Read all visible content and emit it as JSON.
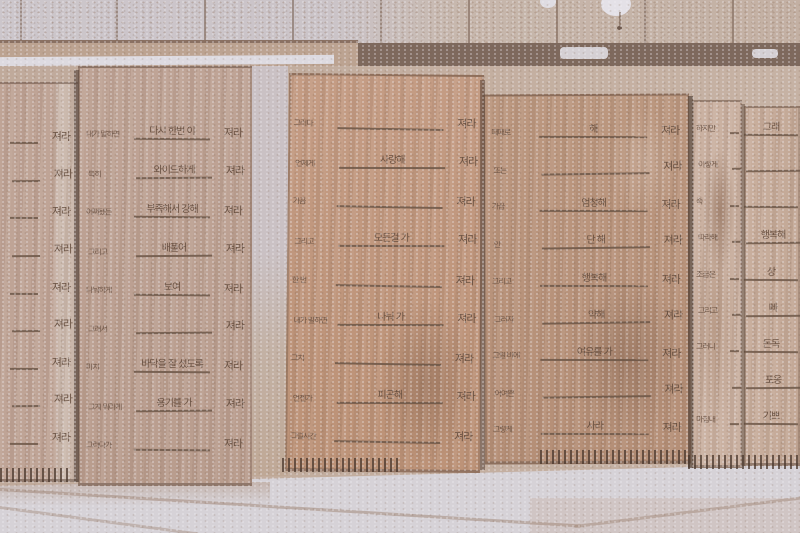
{
  "colors": {
    "tile_light": "#ccc6cb",
    "tile_tan": "#c3b0a3",
    "grout": "#8a7163",
    "shadow_band": "#7e695d",
    "highlight_streak": "#dddae0",
    "wood_a": "#bfa496",
    "wood_b": "#b99d8e",
    "wood_c": "#c49c84",
    "wood_d": "#bb977f",
    "wood_e": "#cab1a1",
    "wood_f": "#c9af9e",
    "ink": "#68513f",
    "floor": "#d6d2d7",
    "floor_line": "#a48b7c"
  },
  "repeated_word": "져라",
  "panels": [
    {
      "name": "board-far-left",
      "rows": [
        {
          "prompt": "",
          "answer": "",
          "suffix": "져라"
        },
        {
          "prompt": "",
          "answer": "",
          "suffix": "져라"
        },
        {
          "prompt": "",
          "answer": "",
          "suffix": "져라"
        },
        {
          "prompt": "",
          "answer": "",
          "suffix": "져라"
        },
        {
          "prompt": "",
          "answer": "",
          "suffix": "져라"
        },
        {
          "prompt": "",
          "answer": "",
          "suffix": "져라"
        },
        {
          "prompt": "",
          "answer": "",
          "suffix": "져라"
        },
        {
          "prompt": "",
          "answer": "",
          "suffix": "져라"
        },
        {
          "prompt": "",
          "answer": "",
          "suffix": "져라"
        }
      ]
    },
    {
      "name": "board-left",
      "rows": [
        {
          "prompt": "내가 말하면",
          "answer": "다시 한번 이",
          "suffix": "져라"
        },
        {
          "prompt": "특히",
          "answer": "와이드하게",
          "suffix": "져라"
        },
        {
          "prompt": "어쩌됐든",
          "answer": "부족해서 강해",
          "suffix": "져라"
        },
        {
          "prompt": "그리고",
          "answer": "배풀어",
          "suffix": "져라"
        },
        {
          "prompt": "나눠하게",
          "answer": "보여",
          "suffix": "져라"
        },
        {
          "prompt": "그래서",
          "answer": "",
          "suffix": "져라"
        },
        {
          "prompt": "마치",
          "answer": "바닥을 잘 섰도록",
          "suffix": "져라"
        },
        {
          "prompt": "그게 뭐라게",
          "answer": "용기를 가",
          "suffix": "져라"
        },
        {
          "prompt": "그러다가",
          "answer": "",
          "suffix": "져라"
        }
      ]
    },
    {
      "name": "board-center",
      "rows": [
        {
          "prompt": "그러다",
          "answer": "",
          "suffix": "져라"
        },
        {
          "prompt": "언제게",
          "answer": "사랑해",
          "suffix": "져라"
        },
        {
          "prompt": "가끔",
          "answer": "",
          "suffix": "져라"
        },
        {
          "prompt": "그리고",
          "answer": "모든걸 가",
          "suffix": "져라"
        },
        {
          "prompt": "한 번",
          "answer": "",
          "suffix": "져라"
        },
        {
          "prompt": "내가 말하면",
          "answer": "나눠 가",
          "suffix": "져라"
        },
        {
          "prompt": "그치",
          "answer": "",
          "suffix": "져라"
        },
        {
          "prompt": "언젠가",
          "answer": "피곤해",
          "suffix": "져라"
        },
        {
          "prompt": "그럴시간",
          "answer": "",
          "suffix": "져라"
        }
      ]
    },
    {
      "name": "board-center-right",
      "rows": [
        {
          "prompt": "때때로",
          "answer": "해",
          "suffix": "져라"
        },
        {
          "prompt": "또는",
          "answer": "",
          "suffix": "져라"
        },
        {
          "prompt": "가끔",
          "answer": "엄청해",
          "suffix": "져라"
        },
        {
          "prompt": "안",
          "answer": "단 해",
          "suffix": "져라"
        },
        {
          "prompt": "그리고",
          "answer": "행복해",
          "suffix": "져라"
        },
        {
          "prompt": "그러자",
          "answer": "약해",
          "suffix": "져라"
        },
        {
          "prompt": "그럴 바에",
          "answer": "여유를 가",
          "suffix": "져라"
        },
        {
          "prompt": "어여쁜",
          "answer": "",
          "suffix": "져라"
        },
        {
          "prompt": "그렇게",
          "answer": "사라",
          "suffix": "져라"
        }
      ]
    },
    {
      "name": "board-right",
      "rows": [
        {
          "prompt": "하지만",
          "answer": "",
          "suffix": ""
        },
        {
          "prompt": "이렇게",
          "answer": "",
          "suffix": ""
        },
        {
          "prompt": "죽",
          "answer": "",
          "suffix": ""
        },
        {
          "prompt": "따라해",
          "answer": "",
          "suffix": ""
        },
        {
          "prompt": "조금은",
          "answer": "",
          "suffix": ""
        },
        {
          "prompt": "그리고",
          "answer": "",
          "suffix": ""
        },
        {
          "prompt": "그러니",
          "answer": "",
          "suffix": ""
        },
        {
          "prompt": "",
          "answer": "",
          "suffix": ""
        },
        {
          "prompt": "마침내",
          "answer": "",
          "suffix": ""
        }
      ]
    },
    {
      "name": "board-far-right",
      "rows": [
        {
          "prompt": "",
          "answer": "그래",
          "suffix": ""
        },
        {
          "prompt": "",
          "answer": "",
          "suffix": ""
        },
        {
          "prompt": "",
          "answer": "",
          "suffix": ""
        },
        {
          "prompt": "",
          "answer": "행복해",
          "suffix": ""
        },
        {
          "prompt": "",
          "answer": "상",
          "suffix": ""
        },
        {
          "prompt": "",
          "answer": "빠",
          "suffix": ""
        },
        {
          "prompt": "",
          "answer": "돈독",
          "suffix": ""
        },
        {
          "prompt": "",
          "answer": "포옹",
          "suffix": ""
        },
        {
          "prompt": "",
          "answer": "기쁘",
          "suffix": ""
        }
      ]
    }
  ]
}
